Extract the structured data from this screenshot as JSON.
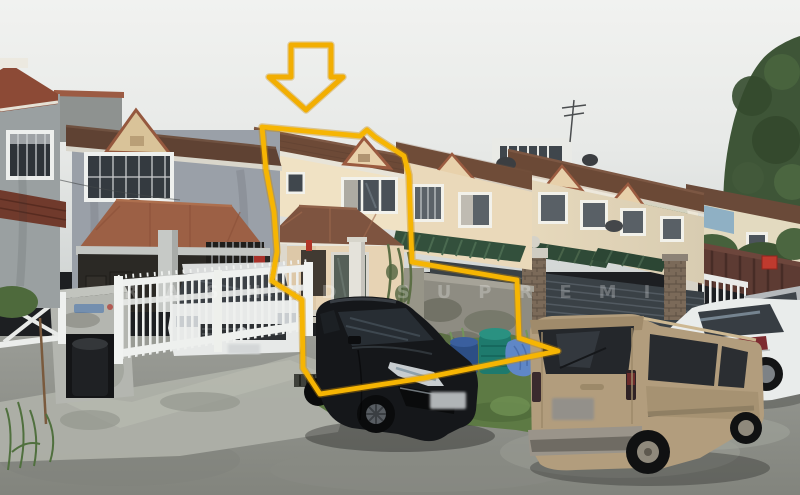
{
  "photo": {
    "kind": "street-photo-terrace-houses",
    "subject": "double-storey-terrace-house-highlighted-for-sale"
  },
  "watermark": {
    "text": "RASHID SUPREMI",
    "color": "#ffffff",
    "opacity": "0.25"
  },
  "annotations": {
    "accent_color": "#f6b503",
    "arrow_icon": "down-arrow-icon",
    "arrow_points": "291,45 331,45 331,77 343,77 306,110 269,77 291,77",
    "outline_icon": "property-boundary-outline",
    "outline_points": "262,127 360,136 367,130 375,137 404,156 409,175 412,262 517,280 519,338 558,351 424,378 320,394 303,368 302,300 272,281 277,252 274,212 266,170"
  },
  "scene": {
    "vehicles": [
      "black-hatchback",
      "gold-compact-van",
      "white-sedan",
      "white-car-behind-gate"
    ],
    "features": [
      "terracotta-roofs",
      "green-awnings",
      "white-metal-gates",
      "blue-water-containers",
      "grass-verge",
      "overcast-sky",
      "satellite-dishes"
    ]
  },
  "palette": {
    "sky_top": "#f1f2f0",
    "sky_bottom": "#d3d7d6",
    "roof_dark_brown": "#6d4a37",
    "roof_terracotta": "#9c6045",
    "wall_cream": "#f0e2c4",
    "wall_grey": "#9aa0a8",
    "awning_green": "#33503c",
    "grass_green": "#5d7a44",
    "asphalt_grey": "#8f918d",
    "van_gold": "#b29d7d",
    "car_black": "#15171a",
    "car_white": "#e9eceb"
  }
}
